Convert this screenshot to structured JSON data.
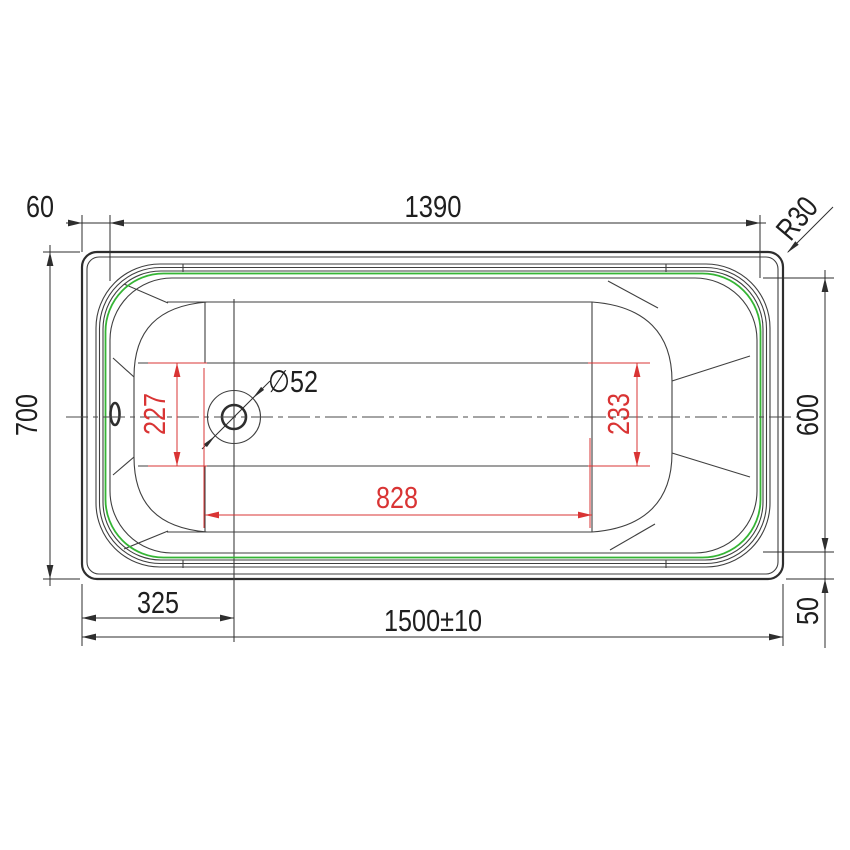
{
  "drawing": {
    "title": "Bathtub top view — dimensioned engineering drawing",
    "colors": {
      "outline": "#2e2e2e",
      "line": "#3f3f3f",
      "centerline": "#4a4a4a",
      "green": "#35b535",
      "red": "#d93434",
      "dim": "#2e2e2e",
      "background": "#ffffff"
    },
    "dims": {
      "left_rim_offset": "60",
      "rim_opening_length": "1390",
      "corner_radius": "R30",
      "overall_width": "700",
      "rim_opening_width": "600",
      "side_rim_offset": "50",
      "drain_offset": "325",
      "overall_length": "1500±10",
      "floor_width_drain_end": "227",
      "floor_width_foot_end": "233",
      "floor_flat_length": "828",
      "drain_diameter": "∅52"
    }
  }
}
